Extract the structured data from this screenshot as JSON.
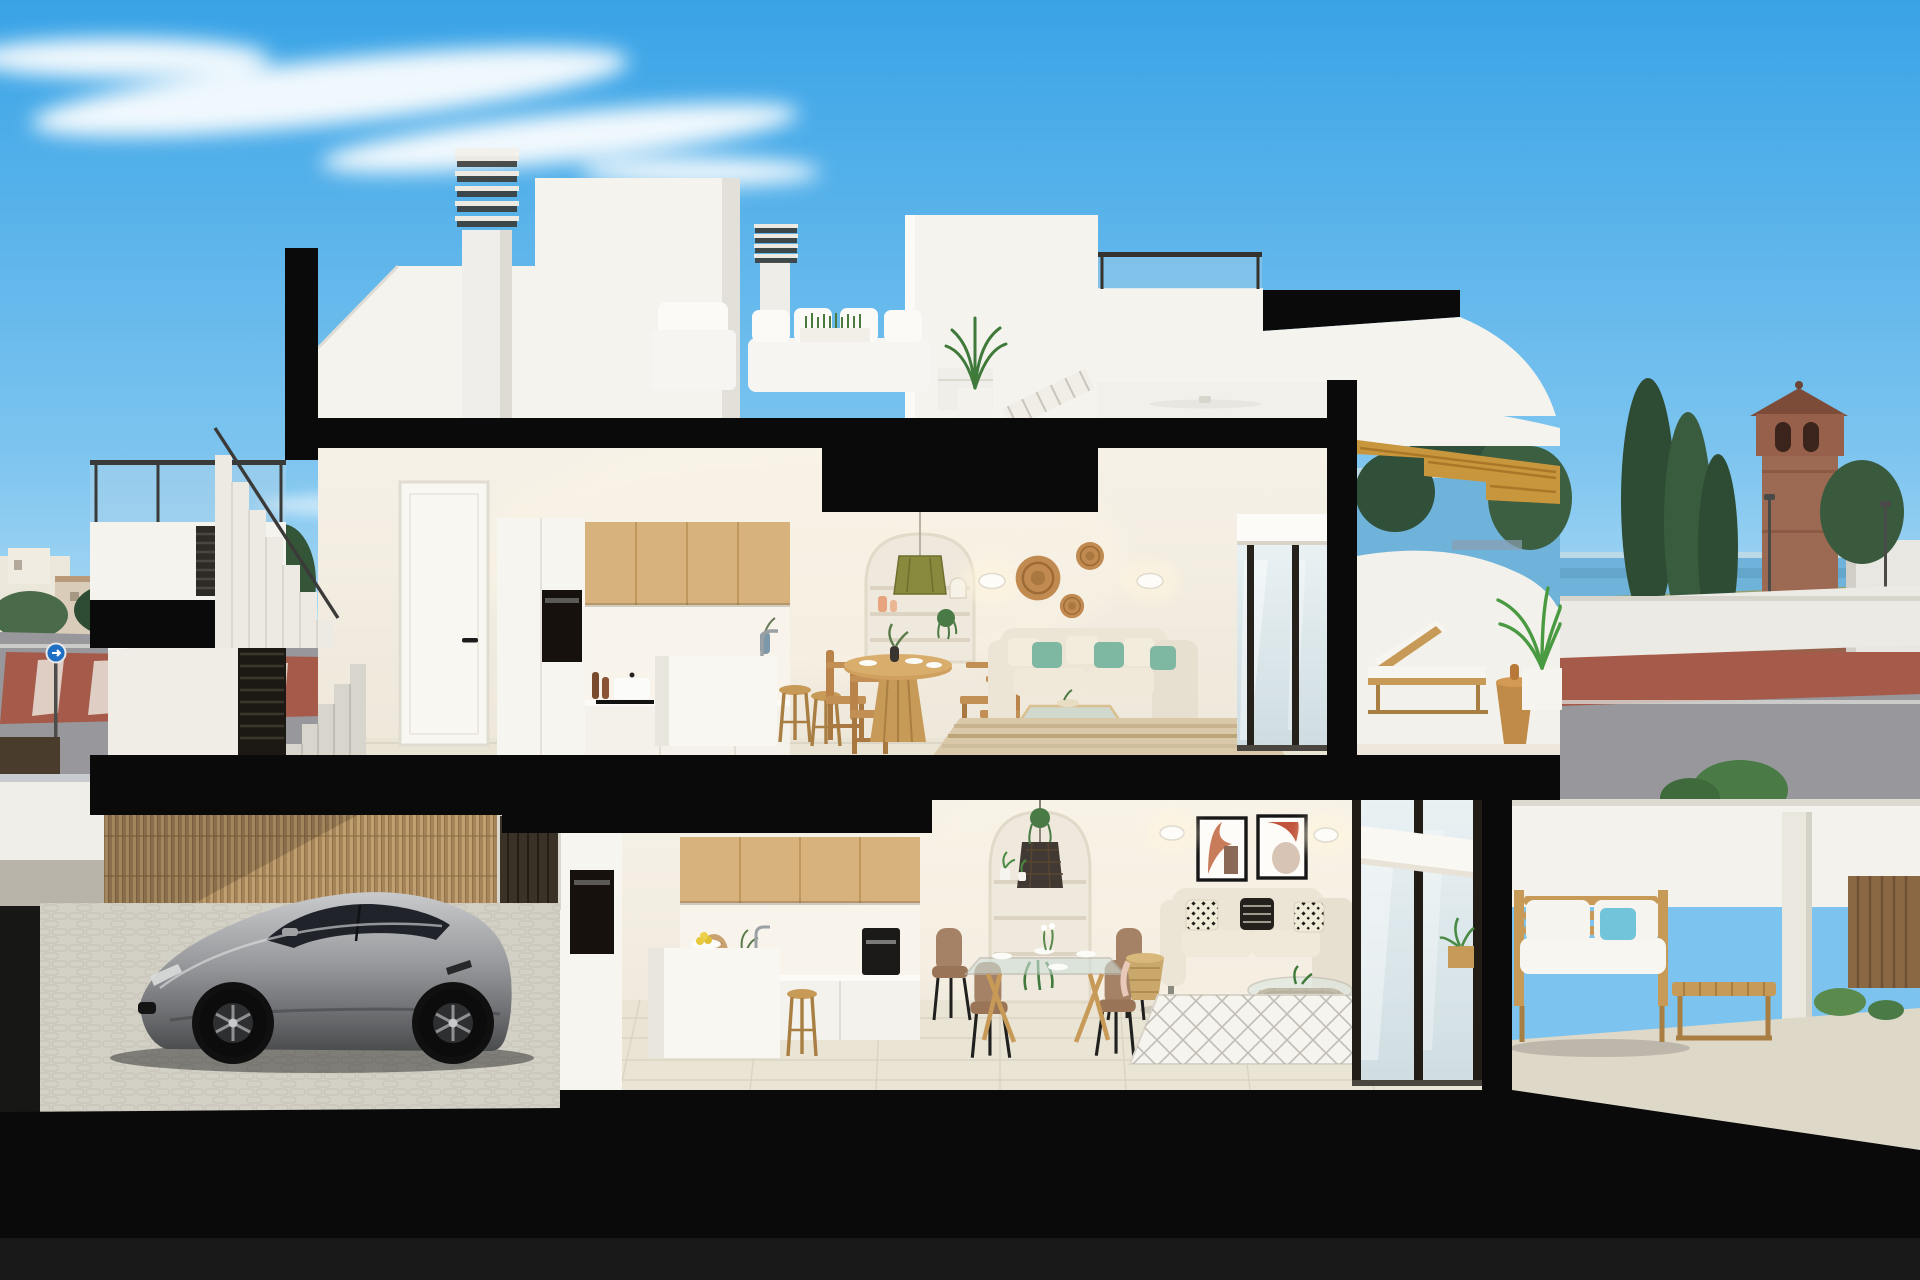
{
  "meta": {
    "domain": "Natural-Image",
    "subject": "3D architectural cutaway render of a two-storey modern Mediterranean villa cross-section",
    "canvas": {
      "width": 1920,
      "height": 1280
    },
    "visible_text": []
  },
  "palette": {
    "sky_top": "#3aa3e6",
    "sky_mid": "#7cc4ef",
    "sky_horizon": "#d9eef9",
    "cloud": "#ffffff",
    "cut": "#0a0a0a",
    "wall": "#f4f3ee",
    "wall_shade": "#e2e0d8",
    "interior_wall": "#f3eee4",
    "wood": "#d7b27c",
    "wood_deep": "#b98f54",
    "wood_stair": "#c8963c",
    "gold": "#c9a050",
    "floor": "#eae4d4",
    "teal": "#7fb8a2",
    "aqua": "#72c4da",
    "rattan": "#bf8a4e",
    "sofa_cream": "#ece5d6",
    "glass": "#dce9ee",
    "brick": "#9c6a52",
    "tree_dark": "#2e4b33",
    "tree_mid": "#4a6b4a",
    "palm": "#4a9a42",
    "road": "#98989c",
    "pave_red": "#a55a4a",
    "bamboo": "#c0a070",
    "bamboo_dark": "#a5845a",
    "concrete": "#d8d5cd",
    "car_body": "#a9abad",
    "car_glass": "#20242a",
    "oven": "#16110d",
    "olive_lamp": "#8a8a3e"
  },
  "scene": {
    "sky": {
      "clouds": 3,
      "description": "clear blue sky, wispy cloud upper left"
    },
    "background_left": {
      "town": "low beige buildings and dark green trees",
      "road": "grey street with red paved crossing and white stripes",
      "sign": "blue circular traffic sign on pole"
    },
    "background_right": {
      "sea": "thin blue sea strip at horizon",
      "tower": "brick watchtower with pitched roof and arched openings",
      "trees": "tall cypresses and bushes",
      "street": "red pavement and grey road with lamp posts"
    },
    "roof_level": {
      "chimneys": 2,
      "chimney_style": "white shafts with louvered caps",
      "stair_bulkhead": "white volume",
      "terrace_furniture": [
        "white lounge chair",
        "white sofa with four pillows and grass planter box",
        "slatted coffee table",
        "potted palm",
        "tilted slatted parasol",
        "tall palm in planter"
      ],
      "extras": [
        "glass roof railing",
        "black pergola beam",
        "curved white parapet"
      ]
    },
    "upper_floor": {
      "entry": {
        "door": "white interior door with black lever handle"
      },
      "kitchen": {
        "upper_cabinets": "light oak",
        "oven": "built-in black column oven",
        "counter_items": [
          "pepper grinders",
          "white pot with lid",
          "cutting board",
          "bud vase"
        ],
        "island": "white block with faucet",
        "stools": 2
      },
      "dining": {
        "table": "round slatted wooden pedestal table",
        "chairs": 4,
        "tableware": "white plates, dark vase with greenery"
      },
      "arched_niche": {
        "shelves": 3,
        "pendant": "olive green drum shade",
        "decor": [
          "peach vases",
          "trailing plant",
          "small arch ornament"
        ]
      },
      "living": {
        "sofa": "cream chaise sofa with cream and teal cushions",
        "coffee_table": "glass top with brass frame",
        "rug": "striped jute",
        "wall_decor": "three woven rattan discs",
        "sconces": 2
      },
      "glazing": {
        "sliding_door": "dark framed glass with white roller blind box"
      },
      "terrace": {
        "sun_lounger": "wood frame with white cushion",
        "side_table": "turned wood pedestal",
        "plant": "palm in white cube pot",
        "stair": "golden wood staircase to roof",
        "ceiling_fan": "white"
      }
    },
    "lower_floor": {
      "kitchen": {
        "upper_cabinets": "light oak",
        "oven": "black built-in",
        "coffee_machine": "black",
        "island": "white block with lemon bowl",
        "stool": "wooden"
      },
      "arched_niche": {
        "shelves": 3,
        "pendant": "dark wicker cage",
        "decor": [
          "potted plants",
          "trailing plant"
        ]
      },
      "dining": {
        "table": "glass top with angled wooden legs",
        "chairs": "4 tan upholstered",
        "tableware": "white plates and flower centerpiece"
      },
      "living": {
        "sofa": "cream sofa with black-and-white patterned pillows",
        "side_table": "woven basket with blanket",
        "coffee_table": "oval rattan with glass top",
        "rug": "white with grey diamond lattice",
        "art": "two framed abstract prints",
        "sconces": 2
      },
      "glazing": {
        "sliding_doors": "dark framed glass with white roller blind"
      },
      "terrace": {
        "outdoor_sofa": "wooden slat sofa with white cushions and light blue pillow",
        "table": "low wooden slat table",
        "plants": "potted greenery"
      }
    },
    "street_entry": {
      "wall": "white rendered wall",
      "gate": "black louvered pedestrian gate",
      "steps": "concrete stair rising to entry hall"
    },
    "carport": {
      "fence": "reed/bamboo screen",
      "post": "rendered pier with concrete cap",
      "paving": "light cobblestone",
      "car": "silver-grey sports coupe, two visible alloy wheels"
    },
    "structure": {
      "cut_surfaces": "thick matte black slabs and mullions",
      "ground": "black base band"
    }
  }
}
